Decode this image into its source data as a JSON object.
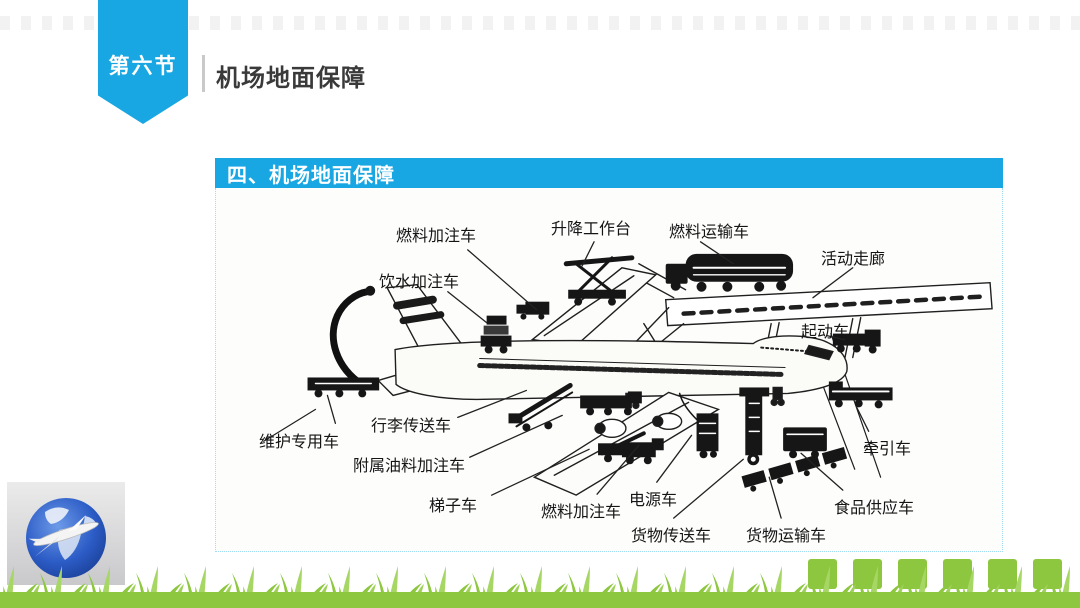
{
  "slide": {
    "ribbon_label": "第六节",
    "header_title": "机场地面保障",
    "panel_title": "四、机场地面保障"
  },
  "colors": {
    "accent_cyan": "#18a7e2",
    "grass_green": "#8dc63f",
    "grass_light": "#a6d764",
    "diagram_ink": "#1f1f1f",
    "header_text": "#3a3a3a"
  },
  "diagram": {
    "subject": "airplane-ground-support-vehicles",
    "labels": [
      {
        "id": "label-fuel-filling-truck-top",
        "text": "燃料加注车",
        "x": 180,
        "y": 34,
        "line": [
          253,
          62,
          322,
          122
        ]
      },
      {
        "id": "label-lift-platform",
        "text": "升降工作台",
        "x": 335,
        "y": 27,
        "line": [
          380,
          54,
          368,
          78
        ]
      },
      {
        "id": "label-fuel-transport-truck",
        "text": "燃料运输车",
        "x": 453,
        "y": 30,
        "line": [
          487,
          54,
          520,
          76
        ]
      },
      {
        "id": "label-mobile-corridor",
        "text": "活动走廊",
        "x": 605,
        "y": 57,
        "line": [
          640,
          80,
          600,
          110
        ]
      },
      {
        "id": "label-water-truck",
        "text": "饮水加注车",
        "x": 163,
        "y": 80,
        "line": [
          233,
          104,
          272,
          135
        ]
      },
      {
        "id": "label-starter-truck",
        "text": "起动车",
        "x": 585,
        "y": 130,
        "line": [
          614,
          148,
          632,
          152
        ]
      },
      {
        "id": "label-maintenance-vehicle",
        "text": "维护专用车",
        "x": 43,
        "y": 240,
        "line": [
          120,
          236,
          112,
          208
        ]
      },
      {
        "id": "label-baggage-conveyor",
        "text": "行李传送车",
        "x": 155,
        "y": 224,
        "line": [
          243,
          230,
          312,
          203
        ]
      },
      {
        "id": "label-aux-oil-truck",
        "text": "附属油料加注车",
        "x": 137,
        "y": 264,
        "line": [
          255,
          270,
          348,
          228
        ]
      },
      {
        "id": "label-ladder-truck",
        "text": "梯子车",
        "x": 213,
        "y": 304,
        "line": [
          277,
          308,
          375,
          262
        ]
      },
      {
        "id": "label-fuel-filling-truck-bottom",
        "text": "燃料加注车",
        "x": 325,
        "y": 310,
        "line": [
          383,
          307,
          425,
          258
        ]
      },
      {
        "id": "label-power-truck",
        "text": "电源车",
        "x": 413,
        "y": 298,
        "line": [
          443,
          295,
          478,
          248
        ]
      },
      {
        "id": "label-cargo-conveyor",
        "text": "货物传送车",
        "x": 415,
        "y": 334,
        "line": [
          460,
          331,
          530,
          272
        ]
      },
      {
        "id": "label-cargo-transport",
        "text": "货物运输车",
        "x": 530,
        "y": 334,
        "line": [
          568,
          331,
          556,
          290
        ]
      },
      {
        "id": "label-food-supply-truck",
        "text": "食品供应车",
        "x": 618,
        "y": 306,
        "line": [
          630,
          303,
          588,
          266
        ]
      },
      {
        "id": "label-tow-truck",
        "text": "牵引车",
        "x": 647,
        "y": 247,
        "line": [
          656,
          244,
          644,
          220
        ]
      }
    ]
  },
  "footer": {
    "deco_square_count": 6,
    "corner_image": "globe-with-airplane-photo"
  }
}
